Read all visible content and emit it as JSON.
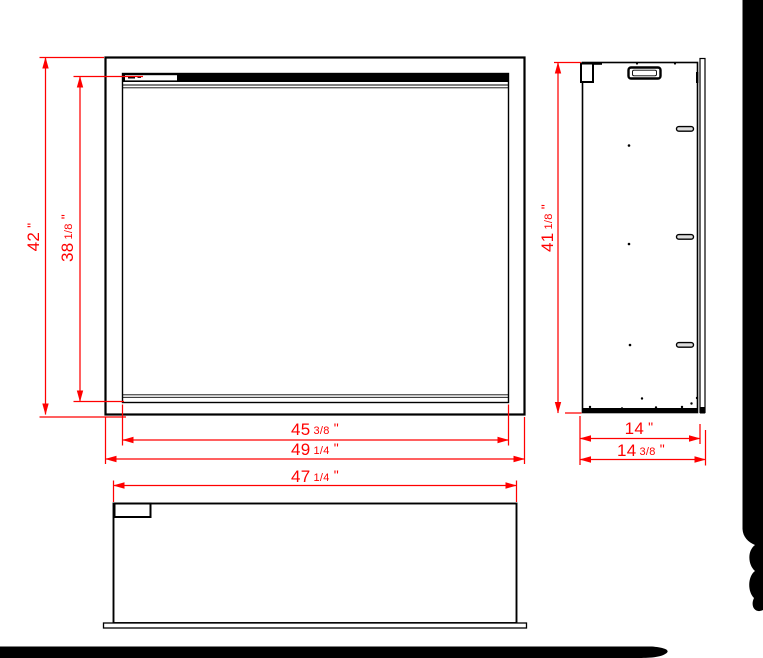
{
  "colors": {
    "dimension_red": "#ff0000",
    "line_black": "#000000",
    "page_white": "#ffffff",
    "backdrop_black": "#000000"
  },
  "dimensions": {
    "front_outer_height": {
      "whole": "42",
      "frac": "",
      "unit": "\""
    },
    "front_opening_height": {
      "whole": "38",
      "frac": "1/8",
      "unit": "\""
    },
    "front_opening_width": {
      "whole": "45",
      "frac": "3/8",
      "unit": "\""
    },
    "front_outer_width": {
      "whole": "49",
      "frac": "1/4",
      "unit": "\""
    },
    "top_view_width": {
      "whole": "47",
      "frac": "1/4",
      "unit": "\""
    },
    "side_height": {
      "whole": "41",
      "frac": "1/8",
      "unit": "\""
    },
    "side_depth_body": {
      "whole": "14",
      "frac": "",
      "unit": "\""
    },
    "side_depth_overall": {
      "whole": "14",
      "frac": "3/8",
      "unit": "\""
    }
  }
}
